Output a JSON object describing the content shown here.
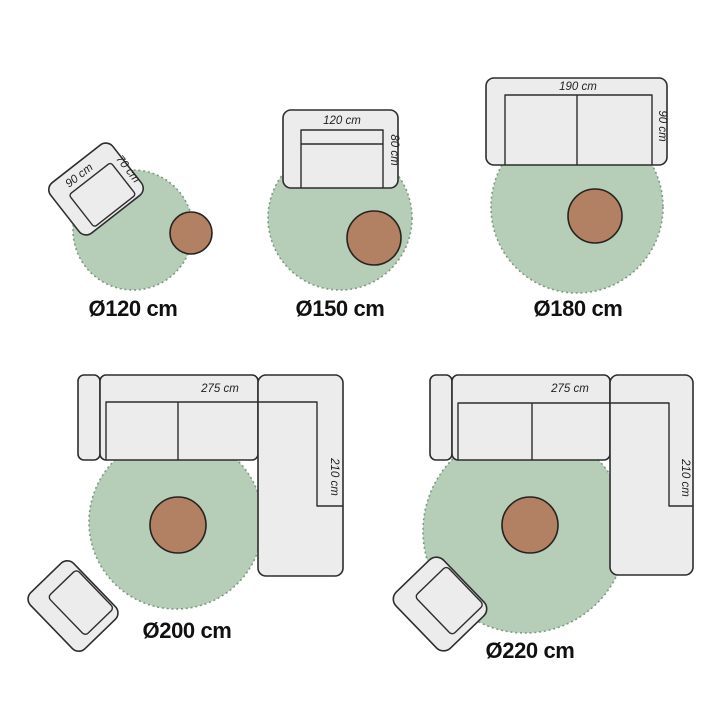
{
  "scenes": [
    {
      "rug_label": "Ø120 cm",
      "dimensions": {
        "width": "90 cm",
        "depth": "70 cm"
      }
    },
    {
      "rug_label": "Ø150 cm",
      "dimensions": {
        "width": "120 cm",
        "depth": "80 cm"
      }
    },
    {
      "rug_label": "Ø180 cm",
      "dimensions": {
        "width": "190 cm",
        "depth": "90 cm"
      }
    },
    {
      "rug_label": "Ø200 cm",
      "dimensions": {
        "width": "275 cm",
        "depth": "210 cm"
      }
    },
    {
      "rug_label": "Ø220 cm",
      "dimensions": {
        "width": "275 cm",
        "depth": "210 cm"
      }
    }
  ],
  "colors": {
    "background": "#ffffff",
    "rug": "#b6cdb8",
    "rug_edge": "#7d9b81",
    "side_table": "#b28062",
    "furniture": "#ececec",
    "outline": "#2d2d2d",
    "label_text": "#111111",
    "dimension_text": "#222222"
  }
}
